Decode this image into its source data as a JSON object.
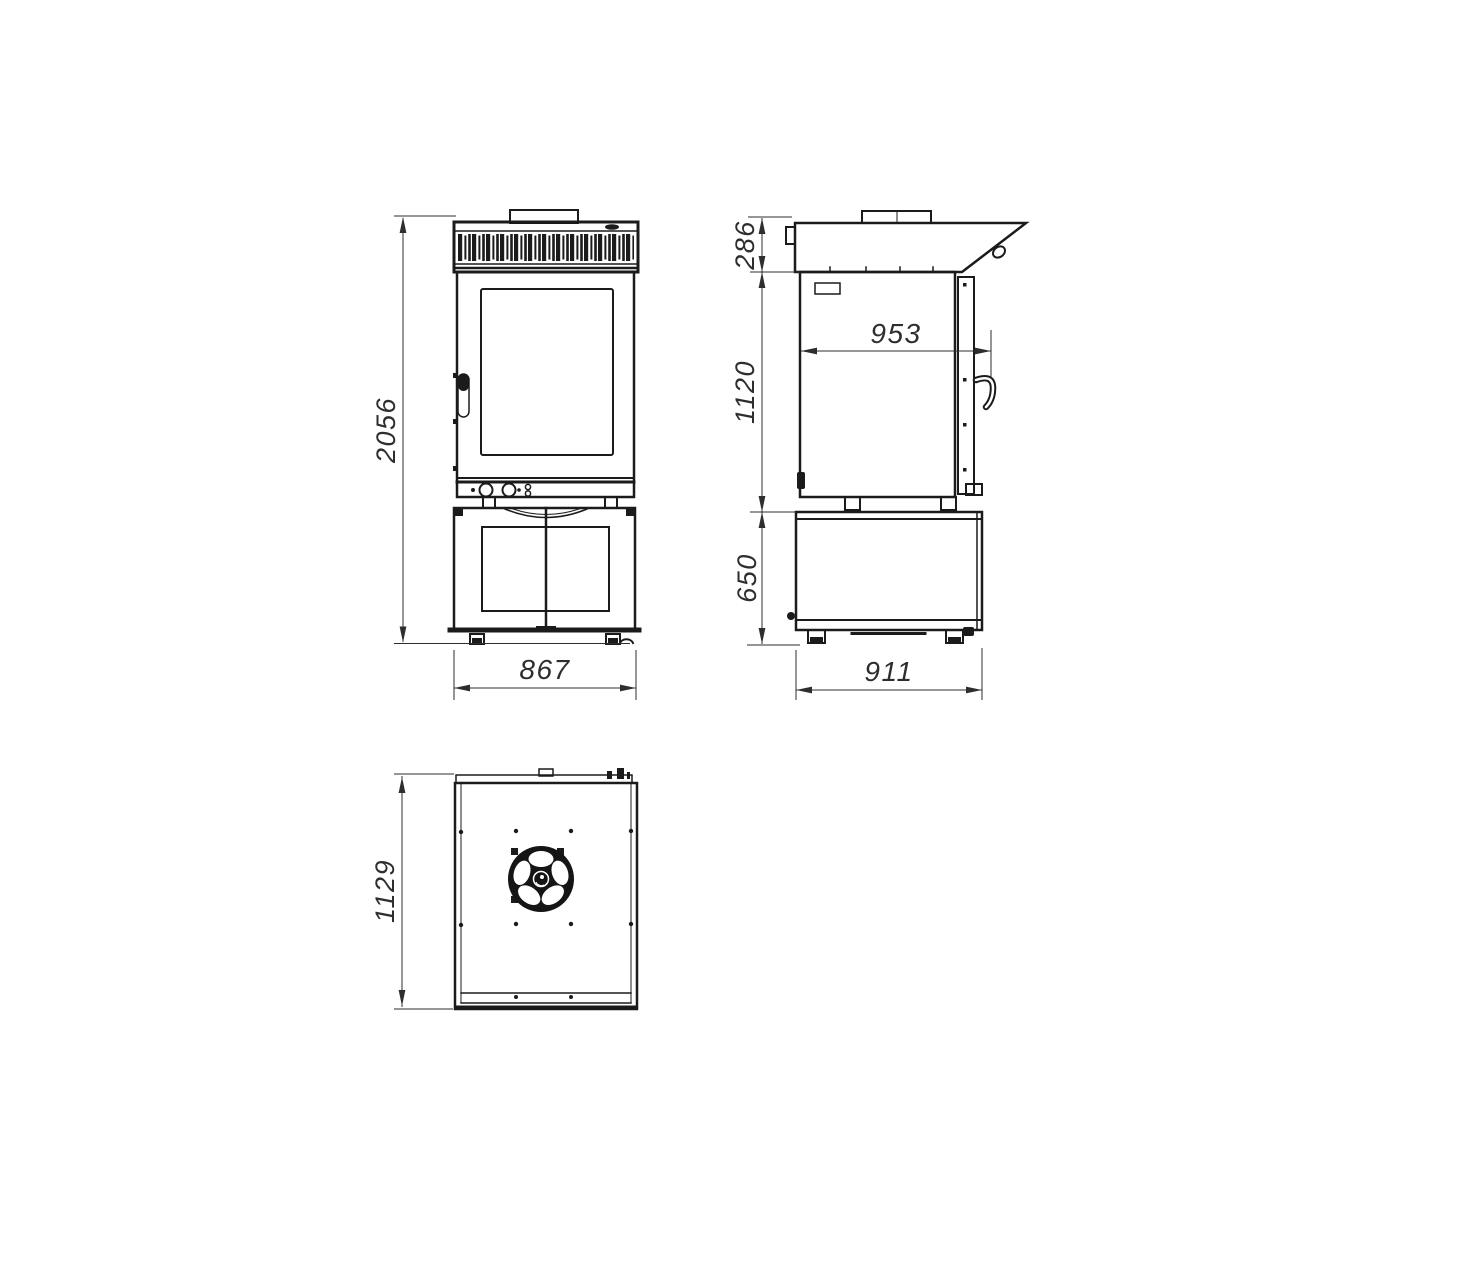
{
  "style": {
    "ink": "#1b1b1b",
    "dimension_color": "#2e2e2e",
    "background": "#ffffff"
  },
  "views": {
    "front": {
      "dims": {
        "overall_height": "2056",
        "overall_width": "867"
      }
    },
    "side": {
      "dims": {
        "hood_height": "286",
        "oven_height": "1120",
        "stand_height": "650",
        "inner_depth": "953",
        "overall_depth": "911"
      }
    },
    "top": {
      "dims": {
        "overall_depth": "1129"
      }
    }
  }
}
